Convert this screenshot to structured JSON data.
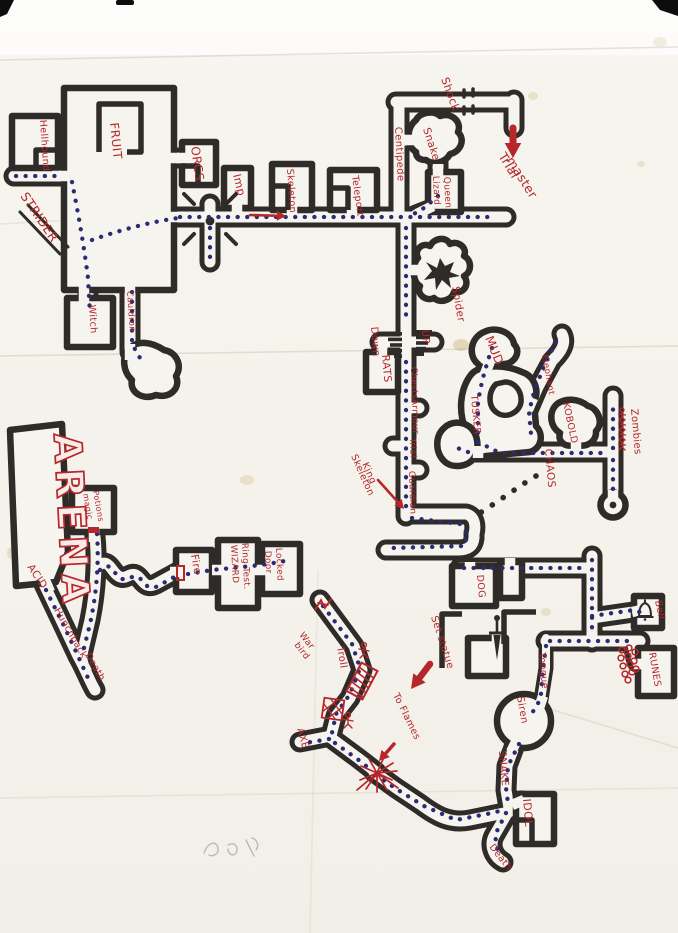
{
  "document": {
    "kind": "hand-drawn dungeon map, scanned sheet of creased paper",
    "medium": "black marker corridors and rooms, blue dotted route trail, red handwritten labels",
    "artifacts": [
      "scanner edge marks at top corners",
      "paper fold creases",
      "yellow stains",
      "illegible pencil scribble near bottom"
    ]
  },
  "palette": {
    "ink": "#2e2b28",
    "paper": "#f6f4ee",
    "red": "#b5272a",
    "trail": "#2b2b74"
  },
  "icons": {
    "bell-icon": "bell",
    "sword-icon": "sword pointing down",
    "stairs-down-icon": "stepped bars",
    "stairs-up-icon": "stepped bars",
    "spider-nest-icon": "spiky black blob in web-shaped cave",
    "portcullis-trap-icon": "red striped gate across corridor",
    "floor-trap-icon": "red cross-hatched floor square",
    "rock-pile-icon": "cluster of red pebbles blocking passage",
    "flames-icon": "red starburst of flames",
    "zombie-figures-icon": "row of red stick figures",
    "stick-figure-icon": "red stick figure",
    "door-marker-icon": "red door bar",
    "junction-dot-icon": "large dark dot at crossroads",
    "trap-marker-icon": "red zigzag mark at dead end"
  },
  "labels": [
    {
      "id": "hellhound",
      "text": "Hellhound",
      "x": 40,
      "y": 120,
      "rot": 86,
      "size": 9.5
    },
    {
      "id": "fruit",
      "text": "FRUIT",
      "x": 110,
      "y": 123,
      "rot": 84,
      "size": 12
    },
    {
      "id": "orcs",
      "text": "ORCS",
      "x": 191,
      "y": 147,
      "rot": 82,
      "size": 12
    },
    {
      "id": "imp",
      "text": "Imp",
      "x": 233,
      "y": 175,
      "rot": 76,
      "size": 11
    },
    {
      "id": "skeleton",
      "text": "Skeleton",
      "x": 287,
      "y": 169,
      "rot": 86,
      "size": 9.5
    },
    {
      "id": "teleport",
      "text": "Teleport",
      "x": 352,
      "y": 176,
      "rot": 82,
      "size": 9.5
    },
    {
      "id": "strider",
      "text": "STRIDER",
      "x": 20,
      "y": 196,
      "rot": 56,
      "size": 12.5
    },
    {
      "id": "shock",
      "text": "Shock",
      "x": 441,
      "y": 79,
      "rot": 70,
      "size": 11
    },
    {
      "id": "centipede",
      "text": "Centipede",
      "x": 395,
      "y": 127,
      "rot": 87,
      "size": 10
    },
    {
      "id": "snake-north",
      "text": "Snake",
      "x": 423,
      "y": 129,
      "rot": 72,
      "size": 10.5
    },
    {
      "id": "lizard",
      "text": "Lizard",
      "x": 433,
      "y": 176,
      "rot": 87,
      "size": 9
    },
    {
      "id": "queen",
      "text": "Queen",
      "x": 444,
      "y": 177,
      "rot": 87,
      "size": 9
    },
    {
      "id": "trial-master-1",
      "text": "Trial",
      "x": 498,
      "y": 156,
      "rot": 58,
      "size": 12.5
    },
    {
      "id": "trial-master-2",
      "text": "master",
      "x": 506,
      "y": 160,
      "rot": 58,
      "size": 12.5
    },
    {
      "id": "spider",
      "text": "Spider",
      "x": 452,
      "y": 287,
      "rot": 80,
      "size": 10.5
    },
    {
      "id": "down",
      "text": "Down",
      "x": 371,
      "y": 327,
      "rot": 85,
      "size": 10
    },
    {
      "id": "rats",
      "text": "RATS",
      "x": 382,
      "y": 355,
      "rot": 85,
      "size": 10.5
    },
    {
      "id": "up",
      "text": "UP",
      "x": 422,
      "y": 330,
      "rot": 85,
      "size": 10
    },
    {
      "id": "chests",
      "text": "Chests",
      "x": 411,
      "y": 367,
      "rot": 88,
      "size": 8.8
    },
    {
      "id": "armour",
      "text": "Armour",
      "x": 412,
      "y": 399,
      "rot": 88,
      "size": 8.8
    },
    {
      "id": "trial",
      "text": "Trial",
      "x": 410,
      "y": 438,
      "rot": 88,
      "size": 8.8
    },
    {
      "id": "guardian",
      "text": "Guardian",
      "x": 409,
      "y": 471,
      "rot": 88,
      "size": 8.8
    },
    {
      "id": "skeleton-king-1",
      "text": "Skeleton",
      "x": 351,
      "y": 456,
      "rot": 66,
      "size": 9.5
    },
    {
      "id": "skeleton-king-2",
      "text": "King",
      "x": 362,
      "y": 464,
      "rot": 66,
      "size": 9.5
    },
    {
      "id": "mud",
      "text": "MUD",
      "x": 485,
      "y": 338,
      "rot": 68,
      "size": 12
    },
    {
      "id": "elephant",
      "text": "Elephant",
      "x": 542,
      "y": 355,
      "rot": 80,
      "size": 8.5
    },
    {
      "id": "tusker",
      "text": "TUSKER",
      "x": 471,
      "y": 395,
      "rot": 85,
      "size": 9.5
    },
    {
      "id": "kobold",
      "text": "KOBOLD",
      "x": 563,
      "y": 403,
      "rot": 78,
      "size": 9.5
    },
    {
      "id": "chaos",
      "text": "CHAOS",
      "x": 545,
      "y": 449,
      "rot": 85,
      "size": 10.5
    },
    {
      "id": "zombies",
      "text": "Zombies",
      "x": 631,
      "y": 409,
      "rot": 85,
      "size": 10
    },
    {
      "id": "arena",
      "text": "ARENA",
      "x": 54,
      "y": 434,
      "rot": 87,
      "size": 38,
      "style": "bubble"
    },
    {
      "id": "magic",
      "text": "magic",
      "x": 83,
      "y": 494,
      "rot": 80,
      "size": 8
    },
    {
      "id": "potions",
      "text": "Potions",
      "x": 93,
      "y": 491,
      "rot": 80,
      "size": 8
    },
    {
      "id": "acid",
      "text": "ACID",
      "x": 27,
      "y": 567,
      "rot": 56,
      "size": 10.5
    },
    {
      "id": "hunchback",
      "text": "Hunchback",
      "x": 54,
      "y": 610,
      "rot": 60,
      "size": 9.5
    },
    {
      "id": "death-west",
      "text": "Death",
      "x": 85,
      "y": 655,
      "rot": 60,
      "size": 9.5
    },
    {
      "id": "fire",
      "text": "Fire",
      "x": 191,
      "y": 555,
      "rot": 80,
      "size": 10.5
    },
    {
      "id": "wizard",
      "text": "WIZARD",
      "x": 231,
      "y": 545,
      "rot": 87,
      "size": 8.8
    },
    {
      "id": "ring-test",
      "text": "Ring Test.",
      "x": 242,
      "y": 543,
      "rot": 87,
      "size": 8.8
    },
    {
      "id": "door",
      "text": "Door",
      "x": 265,
      "y": 551,
      "rot": 87,
      "size": 8.8
    },
    {
      "id": "locked",
      "text": "Locked",
      "x": 276,
      "y": 548,
      "rot": 87,
      "size": 8.8
    },
    {
      "id": "witch",
      "text": "Witch",
      "x": 89,
      "y": 305,
      "rot": 86,
      "size": 9.5
    },
    {
      "id": "cauldron",
      "text": "Cauldron",
      "x": 127,
      "y": 291,
      "rot": 86,
      "size": 8.5
    },
    {
      "id": "war-bird-1",
      "text": "War",
      "x": 299,
      "y": 635,
      "rot": 52,
      "size": 9
    },
    {
      "id": "war-bird-2",
      "text": "bird",
      "x": 294,
      "y": 645,
      "rot": 52,
      "size": 9
    },
    {
      "id": "troll",
      "text": "Troll",
      "x": 337,
      "y": 647,
      "rot": 80,
      "size": 10
    },
    {
      "id": "axe",
      "text": "AXE",
      "x": 297,
      "y": 729,
      "rot": 74,
      "size": 10
    },
    {
      "id": "to-flames",
      "text": "To Flames",
      "x": 393,
      "y": 695,
      "rot": 64,
      "size": 9.5
    },
    {
      "id": "set-statue",
      "text": "Set statue",
      "x": 431,
      "y": 617,
      "rot": 72,
      "size": 10
    },
    {
      "id": "dog",
      "text": "DOG",
      "x": 477,
      "y": 575,
      "rot": 85,
      "size": 9.5
    },
    {
      "id": "bell",
      "text": "Bell",
      "x": 655,
      "y": 601,
      "rot": 78,
      "size": 9.5
    },
    {
      "id": "runes",
      "text": "RUNES",
      "x": 649,
      "y": 653,
      "rot": 80,
      "size": 9.5
    },
    {
      "id": "tongue",
      "text": "Tongue",
      "x": 539,
      "y": 653,
      "rot": 85,
      "size": 9.5
    },
    {
      "id": "siren",
      "text": "Siren",
      "x": 517,
      "y": 697,
      "rot": 80,
      "size": 10
    },
    {
      "id": "snake-south",
      "text": "SNAKE",
      "x": 499,
      "y": 751,
      "rot": 85,
      "size": 10
    },
    {
      "id": "idol",
      "text": "IDOL",
      "x": 523,
      "y": 799,
      "rot": 85,
      "size": 11
    },
    {
      "id": "death-south",
      "text": "Death",
      "x": 489,
      "y": 847,
      "rot": 52,
      "size": 9.5
    }
  ],
  "arrows": [
    {
      "id": "corridor-arrow",
      "x1": 250,
      "y1": 215,
      "x2": 286,
      "y2": 216,
      "w": 2.6,
      "head": 9
    },
    {
      "id": "trial-master-arrow",
      "x1": 513,
      "y1": 128,
      "x2": 513,
      "y2": 158,
      "w": 7,
      "head": 15
    },
    {
      "id": "skeleton-king-arrow",
      "x1": 378,
      "y1": 480,
      "x2": 404,
      "y2": 509,
      "w": 2.6,
      "head": 9
    },
    {
      "id": "set-statue-arrow",
      "x1": 430,
      "y1": 664,
      "x2": 411,
      "y2": 689,
      "w": 6.5,
      "head": 14
    },
    {
      "id": "to-flames-arrow",
      "x1": 394,
      "y1": 744,
      "x2": 379,
      "y2": 761,
      "w": 3.5,
      "head": 10
    }
  ]
}
